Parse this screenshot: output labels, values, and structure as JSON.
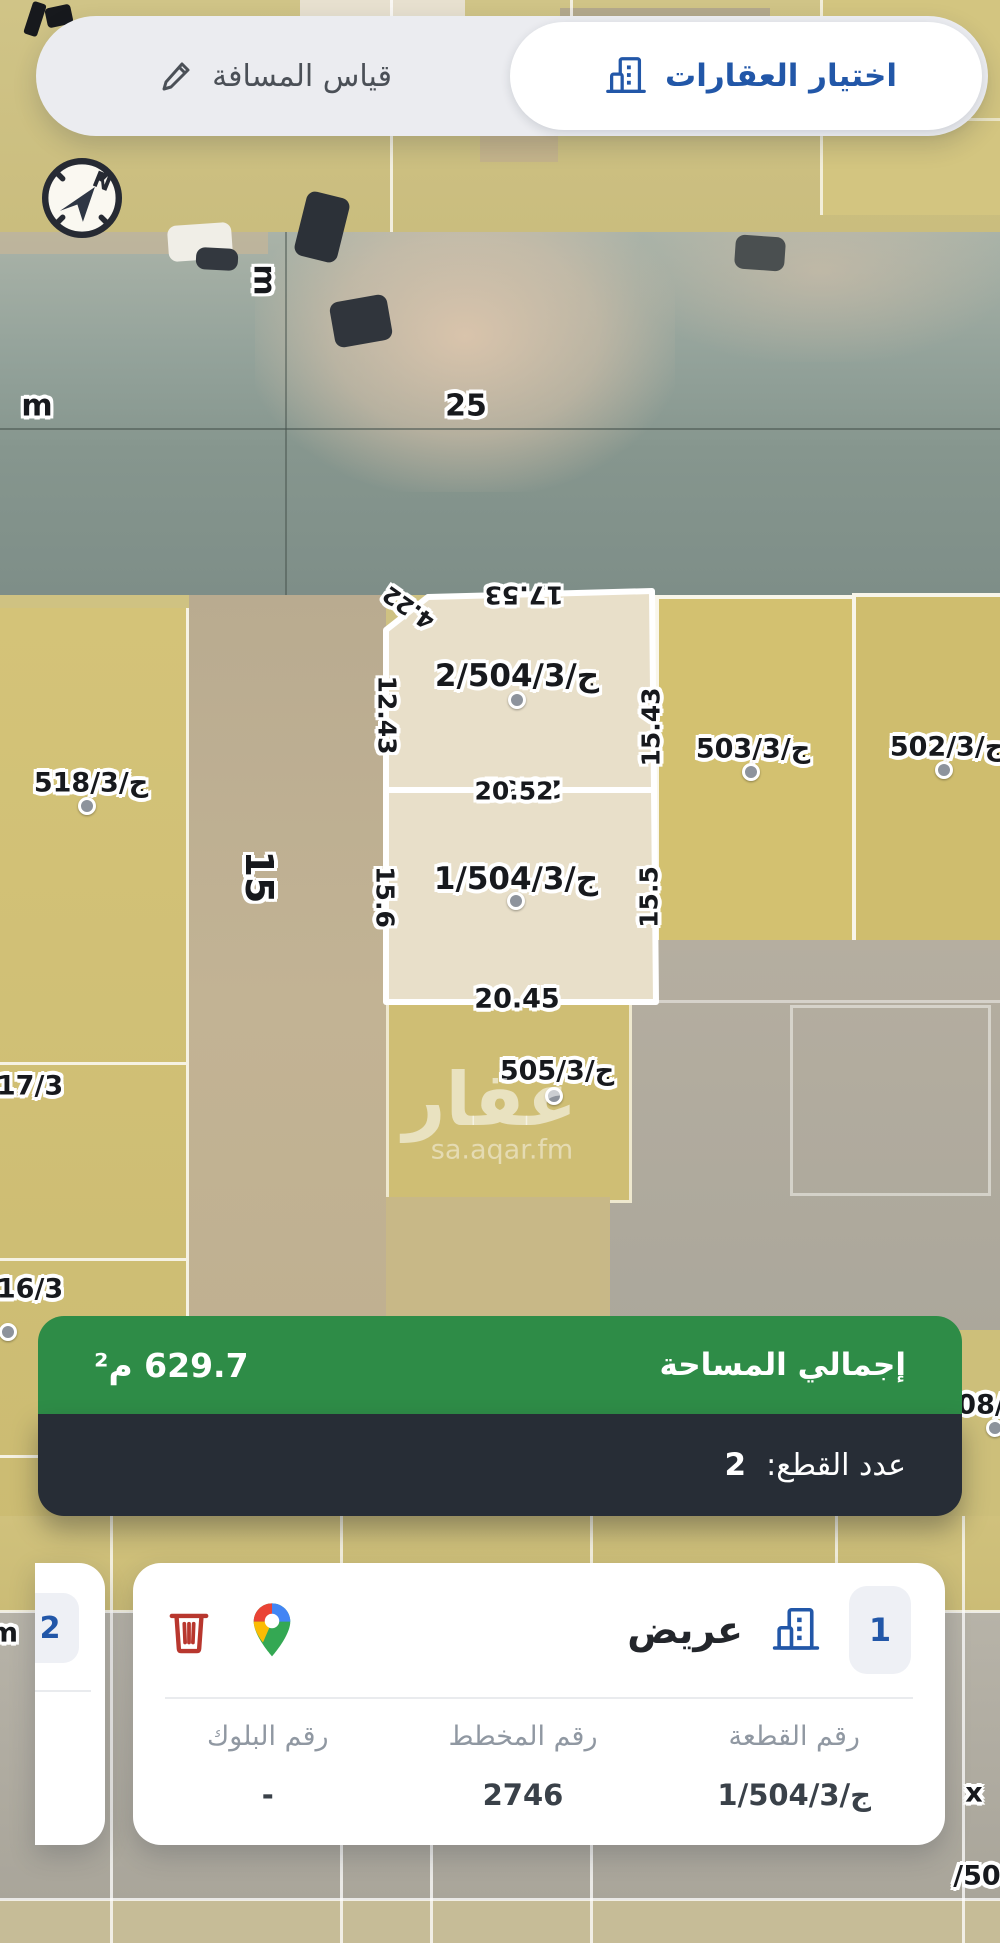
{
  "toolbar": {
    "measure_label": "قياس المسافة",
    "select_label": "اختيار العقارات"
  },
  "compass": {
    "north": "N"
  },
  "map": {
    "street_labels": {
      "m_left": "m",
      "road_25": "25",
      "m_top": "m",
      "street_15": "15"
    },
    "parcel_labels": {
      "p518": "ج/518/3",
      "p503": "ج/503/3",
      "p502": "ج/502/3",
      "p505": "ج/505/3",
      "p517_partial": "17/3",
      "p516_partial": "16/3",
      "p508_partial": "08/",
      "px_partial": "x",
      "p50_partial": "/50",
      "pm_partial": "m"
    },
    "selection": {
      "parcel2_label": "2/ج/504/3",
      "parcel1_label": "1/ج/504/3",
      "dim_top": "17.53",
      "dim_chamfer": "4.22",
      "dim_p2_left": "12.43",
      "dim_p2_right": "15.43",
      "dim_mid_a": "20.52",
      "dim_mid_b": "20.52",
      "dim_p1_left": "15.6",
      "dim_p1_right": "15.5",
      "dim_bottom": "20.45"
    },
    "watermark": {
      "name": "عقار",
      "site": "sa.aqar.fm"
    }
  },
  "summary": {
    "area_label": "إجمالي المساحة",
    "area_value": "629.7 م²",
    "count_label": "عدد القطع:",
    "count_value": "2"
  },
  "cards": {
    "current": {
      "index": "1",
      "name": "عريض",
      "fields": [
        {
          "label": "رقم القطعة",
          "value": "1/ج/504/3"
        },
        {
          "label": "رقم المخطط",
          "value": "2746"
        },
        {
          "label": "رقم البلوك",
          "value": "-"
        }
      ]
    },
    "previous": {
      "index": "2"
    }
  },
  "colors": {
    "accent_blue": "#2257a8",
    "green_bar": "#2e8c47",
    "dark_bar": "#272d36",
    "trash_red": "#b8372e"
  }
}
